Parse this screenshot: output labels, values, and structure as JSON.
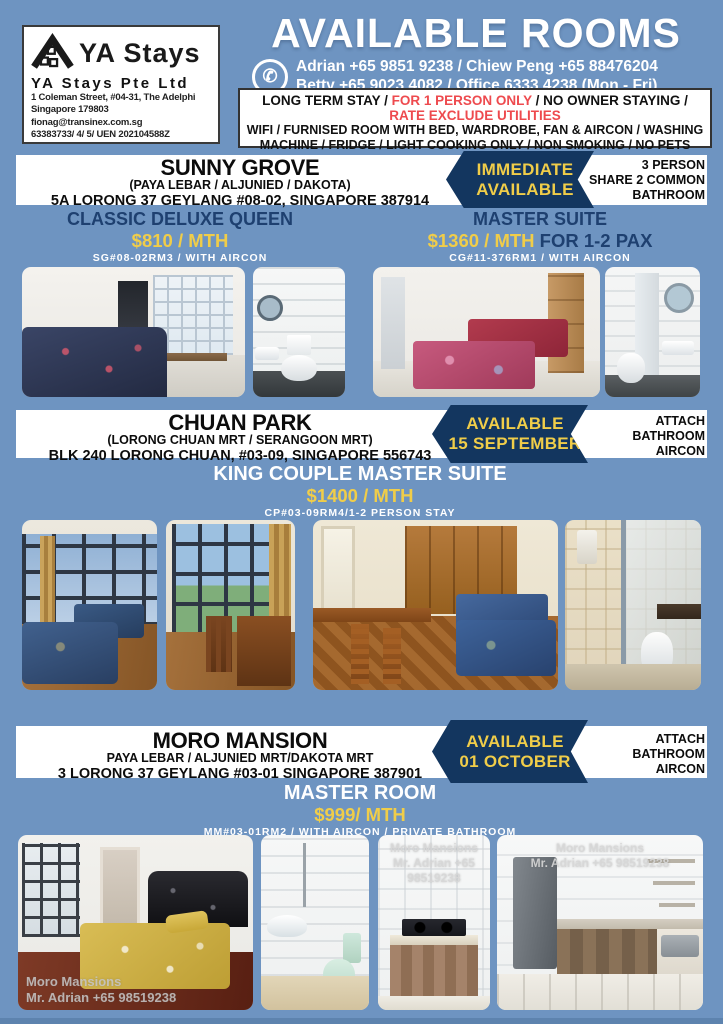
{
  "colors": {
    "page_bg": "#6e94c1",
    "navy": "#13365f",
    "yellow": "#f0cd49",
    "red": "#ee4a4e"
  },
  "company": {
    "brand": "YA Stays",
    "name": "YA Stays Pte Ltd",
    "address1": "1 Coleman Street, #04-31, The Adelphi",
    "address2": "Singapore 179803",
    "email": "fionag@transinex.com.sg",
    "phones_uen": "63383733/ 4/ 5/ UEN 202104588Z"
  },
  "header": {
    "title": "AVAILABLE ROOMS",
    "phone_icon": "phone-icon",
    "phone_line1": "Adrian +65 9851 9238 / Chiew Peng +65 88476204",
    "phone_line2": "Betty +65 9023 4082 / Office 6333 4238 (Mon - Fri)",
    "terms": {
      "l1_black1": "LONG TERM STAY / ",
      "l1_red": "FOR 1 PERSON ONLY",
      "l1_black2": " / NO OWNER STAYING /",
      "l2_red": "RATE EXCLUDE UTILITIES",
      "l3": "WIFI / FURNISED ROOM WITH BED, WARDROBE, FAN & AIRCON / WASHING",
      "l4": "MACHINE / FRIDGE /  LIGHT COOKING ONLY / NON SMOKING / NO PETS"
    }
  },
  "sections": [
    {
      "title": "SUNNY GROVE",
      "subtitle": "(PAYA LEBAR / ALJUNIED / DAKOTA)",
      "address": "5A LORONG 37 GEYLANG #08-02, SINGAPORE 387914",
      "badge": {
        "line1": "IMMEDIATE",
        "line2": "AVAILABLE"
      },
      "info_lines": [
        "3 PERSON",
        "SHARE 2 COMMON",
        "BATHROOM"
      ],
      "rooms": [
        {
          "name": "CLASSIC DELUXE QUEEN",
          "price": "$810 / MTH",
          "price_suffix": "",
          "code": "SG#08-02RM3 / WITH AIRCON"
        },
        {
          "name": "MASTER SUITE",
          "price": "$1360 / MTH",
          "price_suffix": " FOR 1-2 PAX",
          "code": "CG#11-376RM1 / WITH AIRCON"
        }
      ],
      "photos": [
        "bedroom-queen",
        "common-bathroom",
        "twin-bedroom",
        "master-bathroom"
      ]
    },
    {
      "title": "CHUAN PARK",
      "subtitle": "(LORONG CHUAN MRT / SERANGOON MRT)",
      "address": "BLK 240 LORONG CHUAN, #03-09, SINGAPORE 556743",
      "badge": {
        "line1": "AVAILABLE",
        "line2": "15 SEPTEMBER"
      },
      "info_lines": [
        "ATTACH",
        "BATHROOM",
        "AIRCON"
      ],
      "rooms": [
        {
          "name": "KING COUPLE MASTER SUITE",
          "price": "$1400 / MTH",
          "price_suffix": "",
          "code": "CP#03-09RM4/1-2 PERSON STAY"
        }
      ],
      "photos": [
        "bedroom-windows",
        "balcony",
        "master-room",
        "attached-bathroom"
      ]
    },
    {
      "title": "MORO MANSION",
      "subtitle": "PAYA LEBAR / ALJUNIED MRT/DAKOTA MRT",
      "address": "3 LORONG 37 GEYLANG #03-01 SINGAPORE 387901",
      "badge": {
        "line1": "AVAILABLE",
        "line2": "01 OCTOBER"
      },
      "info_lines": [
        "ATTACH",
        "BATHROOM",
        "AIRCON"
      ],
      "rooms": [
        {
          "name": "MASTER ROOM",
          "price": "$999/ MTH",
          "price_suffix": "",
          "code": "MM#03-01RM2 / WITH AIRCON / PRIVATE BATHROOM"
        }
      ],
      "photos": [
        "master-bedroom",
        "private-bathroom",
        "kitchen-stove",
        "kitchen"
      ]
    }
  ],
  "watermark": {
    "line1": "Moro Mansions",
    "line2": "Mr. Adrian +65 98519238"
  }
}
